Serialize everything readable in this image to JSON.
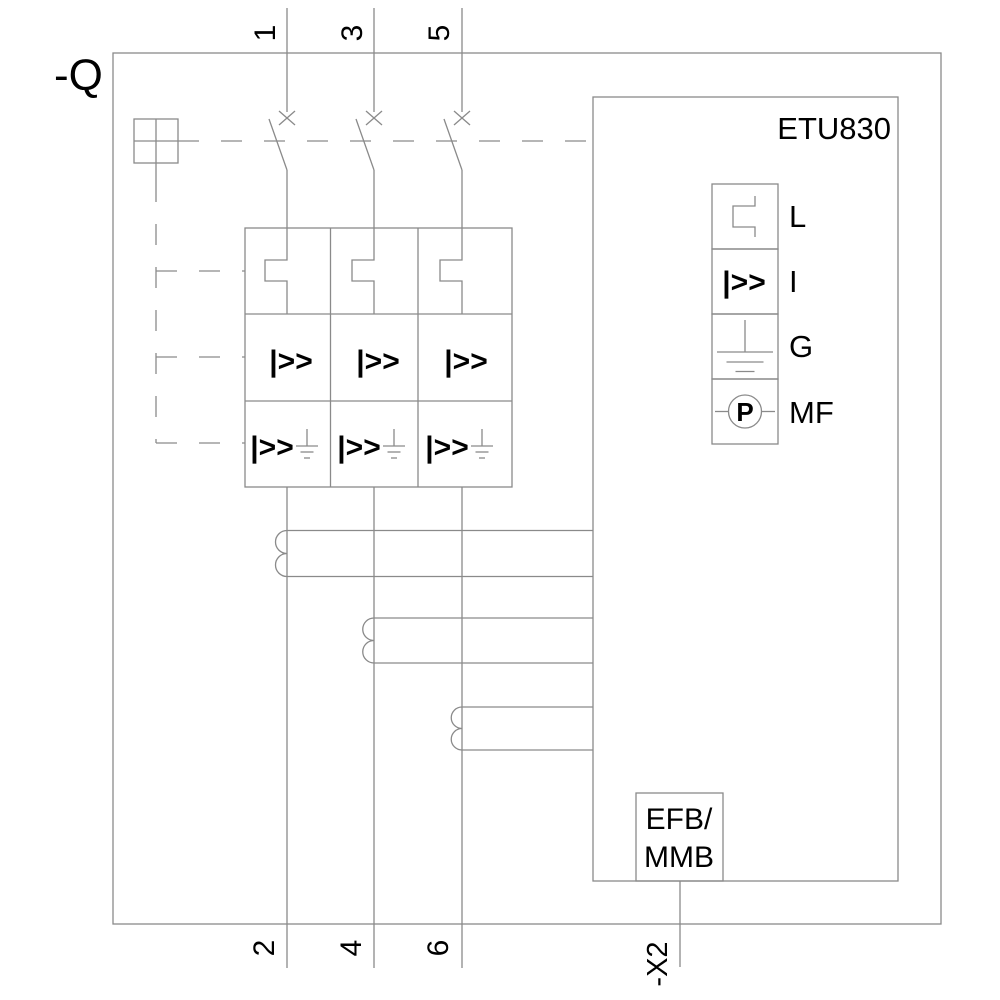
{
  "device_label": "-Q",
  "terminals": {
    "top": [
      "1",
      "3",
      "5"
    ],
    "bottom": [
      "2",
      "4",
      "6"
    ]
  },
  "trip_unit": {
    "label": "ETU830",
    "protection_functions": [
      {
        "label": "L",
        "icon": "long-time-protection-icon"
      },
      {
        "label": "I",
        "icon": "instantaneous-protection-icon"
      },
      {
        "label": "G",
        "icon": "ground-fault-protection-icon"
      },
      {
        "label": "MF",
        "icon": "metering-function-icon"
      }
    ],
    "connector_box": {
      "line1": "EFB/",
      "line2": "MMB"
    },
    "connector_label": "-X2"
  },
  "symbols": {
    "instantaneous": "|>>",
    "power_meter": "P"
  },
  "colors": {
    "line": "#8a8a8a",
    "text": "#000000",
    "background": "#ffffff"
  }
}
